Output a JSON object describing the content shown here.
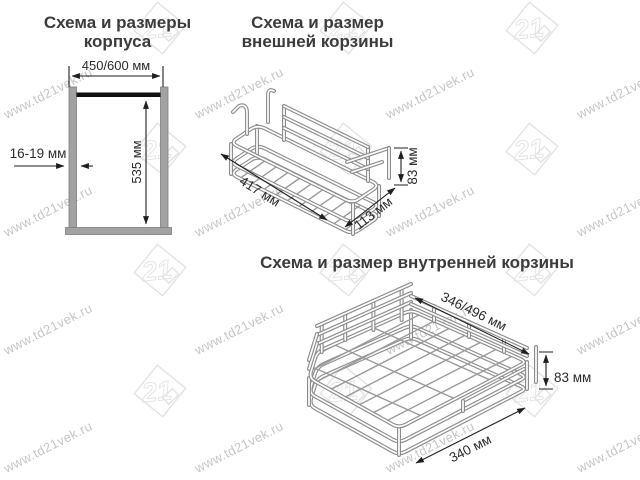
{
  "watermark": {
    "text": "www.td21vek.ru",
    "logo_text": "21"
  },
  "sections": {
    "case": {
      "title": [
        "Схема и размеры",
        "корпуса"
      ],
      "dims": {
        "width": "450/600 мм",
        "height": "535 мм",
        "thickness": "16-19 мм"
      }
    },
    "outer": {
      "title": [
        "Схема и размер",
        "внешней корзины"
      ],
      "dims": {
        "length": "417 мм",
        "depth": "113 мм",
        "height": "83 мм"
      }
    },
    "inner": {
      "title": "Схема и размер внутренней корзины",
      "dims": {
        "width": "346/496 мм",
        "depth": "340 мм",
        "height": "83 мм"
      }
    }
  },
  "colors": {
    "wire": "#8d8d8d",
    "line": "#1f1f1f",
    "wall": "#a2a2a2",
    "title_text": "#3b3b3b",
    "dim_text": "#2b2b2b",
    "watermark_text": "#c6c6c6",
    "watermark_logo": "#e4e4e4",
    "rail_black": "#111111"
  }
}
